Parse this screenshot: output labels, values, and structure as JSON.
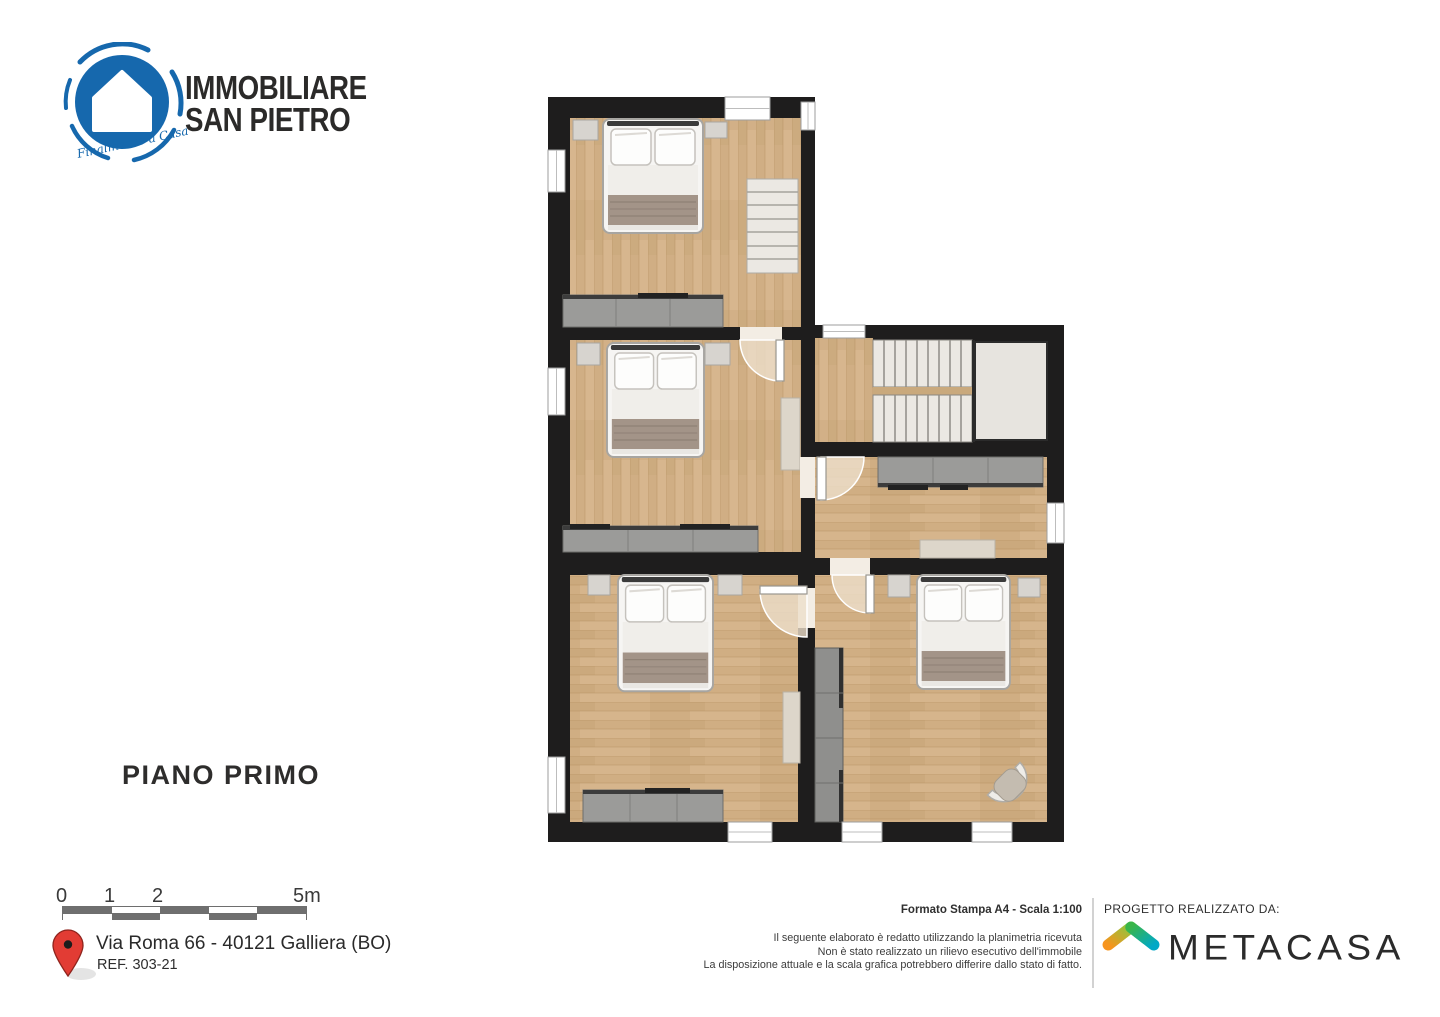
{
  "branding": {
    "line1": "IMMOBILIARE",
    "line2": "SAN PIETRO",
    "tagline": "Finalmente a Casa",
    "logo_blue": "#1668ad"
  },
  "plan": {
    "floor_label": "PIANO PRIMO",
    "wall_color": "#1e1d1d",
    "floor_wood_color": "#d2b087",
    "rooms": [
      {
        "name": "bedroom-top-left",
        "furniture": [
          "double-bed",
          "two-nightstands",
          "dresser",
          "staircase"
        ]
      },
      {
        "name": "bedroom-middle-left",
        "furniture": [
          "double-bed",
          "two-nightstands",
          "wall-cabinet",
          "dresser"
        ]
      },
      {
        "name": "bedroom-bottom-left",
        "furniture": [
          "double-bed",
          "two-nightstands",
          "wall-cabinet",
          "dresser"
        ]
      },
      {
        "name": "hallway-stairwell",
        "furniture": [
          "double-flight-staircase",
          "landing",
          "sideboard",
          "bench"
        ]
      },
      {
        "name": "bedroom-bottom-right",
        "furniture": [
          "double-bed",
          "two-nightstands",
          "wardrobe",
          "armchair"
        ]
      }
    ]
  },
  "scale_bar": {
    "labels": [
      "0",
      "1",
      "2",
      "5m"
    ],
    "total_meters": 5
  },
  "location": {
    "address": "Via Roma 66 - 40121 Galliera (BO)",
    "reference": "REF. 303-21",
    "pin_color": "#e23c34"
  },
  "print_info": {
    "format_line": "Formato Stampa A4 - Scala 1:100",
    "disclaimer_lines": [
      "Il seguente elaborato è redatto utilizzando la planimetria ricevuta",
      "Non è stato realizzato un rilievo esecutivo dell'immobile",
      "La disposizione attuale e la scala grafica potrebbero differire dallo stato di fatto."
    ]
  },
  "credits": {
    "label": "PROGETTO REALIZZATO DA:",
    "company": "METACASA"
  }
}
